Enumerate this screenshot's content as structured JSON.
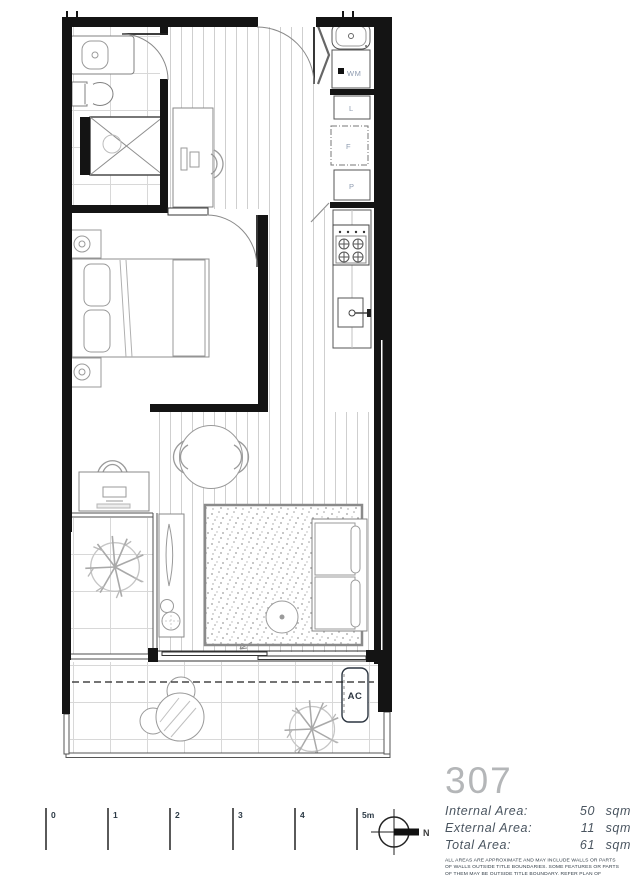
{
  "plan": {
    "fixture_labels": {
      "washing_machine": "WM",
      "linen": "L",
      "fridge": "F",
      "pantry": "P",
      "air_conditioner": "AC"
    }
  },
  "legend": {
    "unit_number": "307",
    "areas": [
      {
        "label": "Internal Area:",
        "value": "50",
        "unit": "sqm"
      },
      {
        "label": "External Area:",
        "value": "11",
        "unit": "sqm"
      },
      {
        "label": "Total Area:",
        "value": "61",
        "unit": "sqm"
      }
    ],
    "disclaimer": "ALL AREAS ARE APPROXIMATE AND MAY INCLUDE WALLS OR PARTS OF WALLS OUTSIDE TITLE BOUNDARIES. SOME FEATURES OR PARTS OF THEM MAY BE OUTSIDE TITLE BOUNDARY. REFER PLAN OF SUBDIVISION FOR TITLE BOUNDARIES"
  },
  "scale_bar": {
    "ticks": [
      "0",
      "1",
      "2",
      "3",
      "4",
      "5m"
    ]
  },
  "north_arrow": {
    "label": "N"
  },
  "colors": {
    "wall": "#141414",
    "fixture_label": "#8e9bb0",
    "area_text": "#4a5560",
    "unit_number": "#b4b6b8",
    "floor_line": "#cfcfcf",
    "tile_line": "#d8d8d8",
    "furniture_line": "#9a9a9a"
  }
}
